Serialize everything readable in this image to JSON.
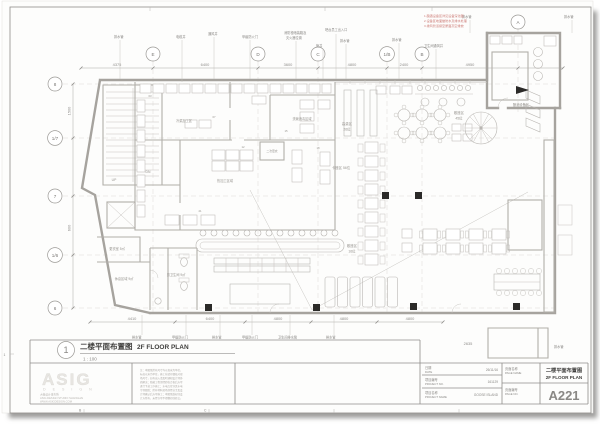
{
  "sheet": {
    "zone_letter_b": "B",
    "zone_letter_c": "C",
    "zone_number_left": "1"
  },
  "drawing_title": {
    "num": "1",
    "cn": "二楼平面布置图",
    "en": "2F FLOOR PLAN",
    "scale": "1 : 100"
  },
  "logo": {
    "name": "ASIG",
    "sub": "D E S I G N",
    "line1": "大椽设计事务所",
    "line2": "ASIG DESIGN STUDIO SHANGHAI",
    "line3": "WWW.ASIGDESIGN.COM"
  },
  "notes_lines": [
    "注：本图纸所有尺寸均以毫米为单位，",
    "标高以米为单位，施工前请仔细核对现",
    "场尺寸，如有出入请及时通知设计师协",
    "商解决；隐蔽工程须经验收合格后方可",
    "进行下道工序施工；水电点位详见水电",
    "专项图纸；所有材料进场须经业主及设",
    "计师确认后方可施工；本图纸版权归设",
    "计方所有，未经许可不得翻印或转交。"
  ],
  "title_block": {
    "date_cn": "日期",
    "date_en": "DATE",
    "date_value": "26/11/16",
    "pno_cn": "项目编号",
    "pno_en": "PROJECT NO.",
    "pno_value": "161129",
    "pname_cn": "项目名称",
    "pname_en": "PROJECT NAME",
    "pname_value": "GOOSE ISLAND",
    "pagename_cn": "页面名称",
    "pagename_en": "PAGE NAME",
    "page_value_cn": "二楼平面布置图",
    "page_value_en": "2F FLOOR PLAN",
    "pageno_cn": "页面编号",
    "pageno_en": "PAGE NO.",
    "pageno_value": "A221"
  },
  "plan": {
    "grid_cols": [
      "E",
      "D",
      "C",
      "1/B",
      "B",
      "A"
    ],
    "grid_rows": [
      "8",
      "1/7",
      "7",
      "1/6",
      "6"
    ],
    "dims_top": [
      "4375",
      "6400",
      "3600",
      "4800",
      "2400",
      "4950"
    ],
    "dims_bottom": [
      "4410",
      "6400",
      "4800",
      "4800",
      "4800"
    ],
    "dim_left_1": "1500",
    "dim_left_2": "600",
    "dim_br": "2635",
    "callouts_top": [
      "排水管",
      "电缆井",
      "通风井",
      "甲级防火门",
      "消防栓暗装箱及",
      "灭火器位置",
      "吧台员工出入口",
      "管井",
      "排水管",
      "排水管",
      "卫生间通风井",
      "排水管",
      "排水管"
    ],
    "callouts_bottom": [
      "排水管",
      "甲级防火门",
      "排水管",
      "甲级防火门",
      "卫生间排水管",
      "排水管",
      "排水管"
    ],
    "red_notes": [
      "1.酿酒设备区详见设备深化图",
      "2.设备区地面做防水及排水处理",
      "3.排风管道接至屋面高空排放"
    ],
    "labels": {
      "brewhouse": "酿酒设备区",
      "high_table_1": "高桌区",
      "high_table_2": "26位",
      "loose_1": "散座区",
      "loose_2": "45位",
      "booth": "卡座区 56位",
      "bar_zone_1": "散座区",
      "bar_zone_2": "16位",
      "hot": "热加工区域",
      "dish": "洗碗消毒区域",
      "cold": "冷菜加工区",
      "change2": "二次更衣",
      "locker": "更衣室 5㎡",
      "rest": "休息区域 9㎡",
      "mens": "男卫生间 9㎡",
      "up": "UP",
      "dn": "DN",
      "eq_tags": [
        "03",
        "07",
        "12",
        "15",
        "18",
        "21"
      ]
    }
  }
}
